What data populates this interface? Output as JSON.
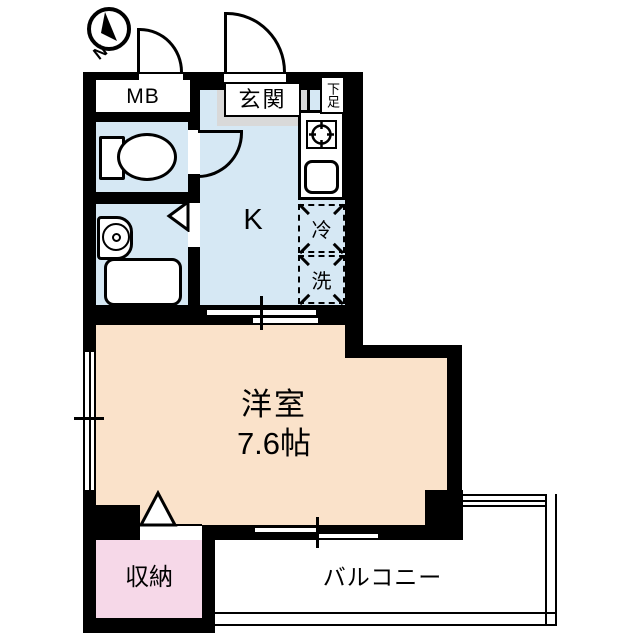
{
  "compass": {
    "north_label": "N"
  },
  "labels": {
    "meter_box": "MB",
    "entrance": "玄関",
    "shoe_box": "下足",
    "kitchen": "K",
    "refrigerator": "冷",
    "washer": "洗",
    "main_room_name": "洋室",
    "main_room_size": "7.6帖",
    "storage": "収納",
    "balcony": "バルコニー"
  },
  "colors": {
    "wall": "#000000",
    "water_area_blue": "#d6e8f4",
    "main_room_peach": "#fae2ca",
    "storage_pink": "#f6d8e8",
    "entrance_gray": "#d9d9d9",
    "background": "#ffffff"
  }
}
